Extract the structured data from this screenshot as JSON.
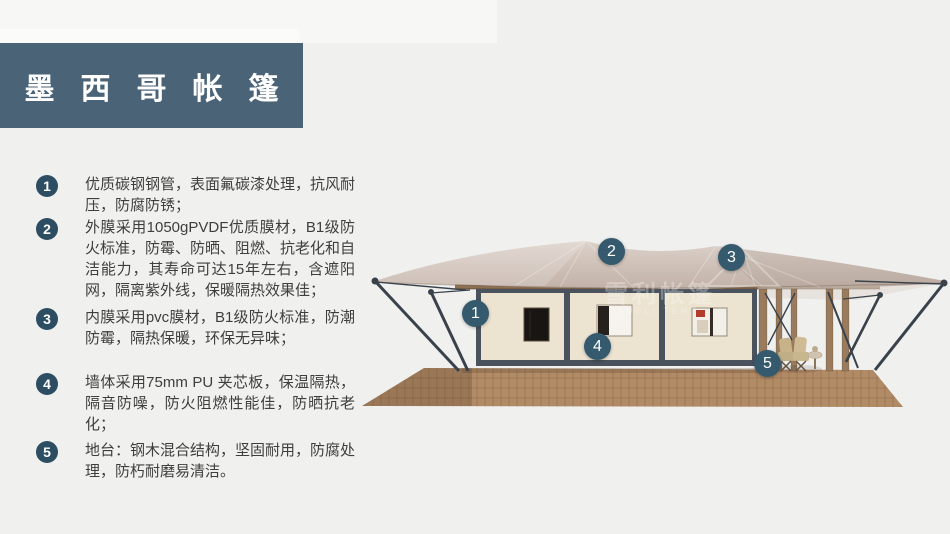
{
  "slide": {
    "title": "墨西哥帐篷"
  },
  "features": [
    {
      "num": "1",
      "text": "优质碳钢钢管，表面氟碳漆处理，抗风耐压，防腐防锈；"
    },
    {
      "num": "2",
      "text": "外膜采用1050gPVDF优质膜材，B1级防火标准，防霉、防晒、阻燃、抗老化和自洁能力，其寿命可达15年左右，含遮阳网，隔离紫外线，保暖隔热效果佳；"
    },
    {
      "num": "3",
      "text": "内膜采用pvc膜材，B1级防火标准，防潮防霉，隔热保暖，环保无异味；"
    },
    {
      "num": "4",
      "text": "墙体采用75mm PU 夹芯板，保温隔热，隔音防噪，防火阻燃性能佳，防晒抗老化；"
    },
    {
      "num": "5",
      "text": "地台：钢木混合结构，坚固耐用，防腐处理，防朽耐磨易清洁。"
    }
  ],
  "tent_image": {
    "markers": [
      {
        "num": "1"
      },
      {
        "num": "2"
      },
      {
        "num": "3"
      },
      {
        "num": "4"
      },
      {
        "num": "5"
      }
    ],
    "watermark": {
      "cn": "雪利帐篷",
      "en": "XUELI TENT"
    }
  },
  "colors": {
    "background": "#f0f0ef",
    "title_bg": "#4a6377",
    "badge": "#2d4d62",
    "marker": "#355a6e",
    "body_text": "#3e3e3e",
    "roof": "#cbbab0",
    "wall": "#ece3d0",
    "frame": "#49525d",
    "deck": "#b18a66"
  }
}
